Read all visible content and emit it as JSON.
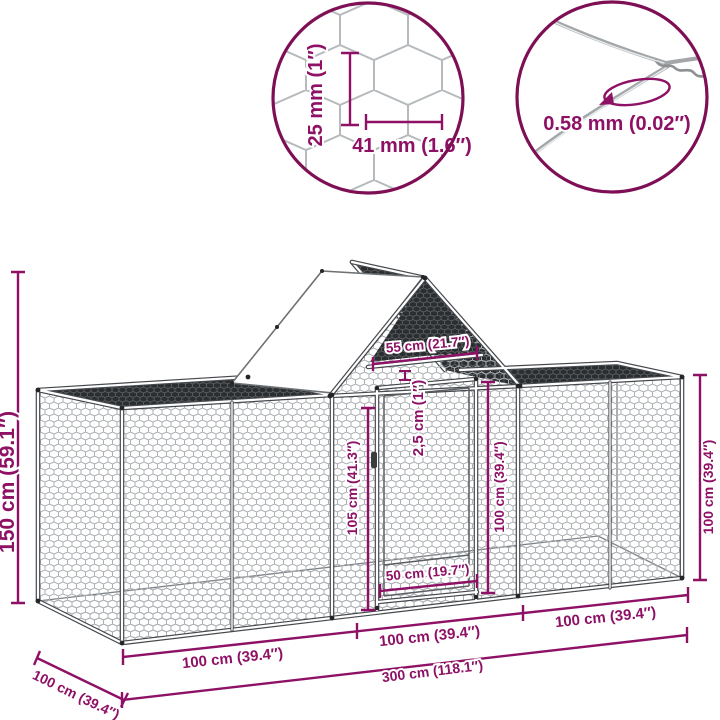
{
  "diagram_title": "Chicken run dimension diagram",
  "colors": {
    "dimension_accent": "#8E1166",
    "circle_outline": "#7E0F55",
    "frame": "#45484C",
    "mesh_line": "#ABAFB2",
    "dark_panel": "#2B2E30",
    "wire": "#A3A7AA"
  },
  "mesh_detail_circle": {
    "cell_height_label": "25 mm (1″)",
    "cell_width_label": "41 mm (1.6″)"
  },
  "wire_detail_circle": {
    "wire_thickness_label": "0.58 mm (0.02″)"
  },
  "dimensions": {
    "total_height": "150 cm (59.1″)",
    "ridge_beam_width": "55 cm (21.7″)",
    "frame_tube_size": "2,5 cm (1″)",
    "door_height": "105 cm (41.3″)",
    "center_wall_height": "100 cm (39.4″)",
    "right_wall_height": "100 cm (39.4″)",
    "door_width": "50 cm (19.7″)",
    "front_length_left": "100 cm (39.4″)",
    "front_length_center": "100 cm (39.4″)",
    "front_length_right": "100 cm (39.4″)",
    "total_length": "300 cm (118.1″)",
    "side_depth": "100 cm (39.4″)"
  }
}
